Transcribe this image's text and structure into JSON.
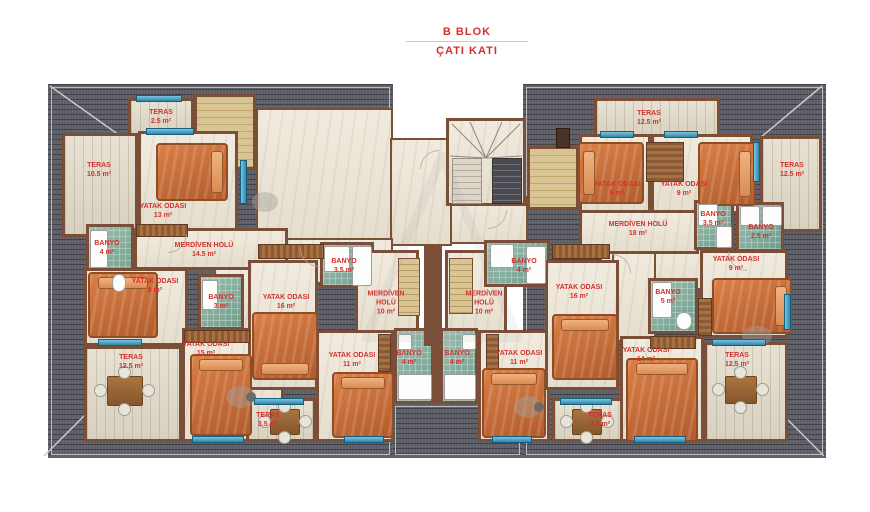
{
  "title": {
    "block": "B BLOK",
    "floor": "ÇATI KATI"
  },
  "colors": {
    "label": "#d4302e",
    "roof": "#5d5e66",
    "wall": "#7b4e38",
    "window": "#2e87ab",
    "bed": "#c96f3e",
    "tile": "#87afa0"
  },
  "rooms": [
    {
      "name": "TERAS",
      "area": "2.5 m²"
    },
    {
      "name": "TERAS",
      "area": "10.5 m²"
    },
    {
      "name": "YATAK ODASI",
      "area": "13 m²"
    },
    {
      "name": "BANYO",
      "area": "4 m²"
    },
    {
      "name": "MERDİVEN HOLÜ",
      "area": "14.5 m²"
    },
    {
      "name": "YATAK ODASI",
      "area": "9 m²"
    },
    {
      "name": "BANYO",
      "area": "3 m²"
    },
    {
      "name": "TERAS",
      "area": "12.5 m²"
    },
    {
      "name": "YATAK ODASI",
      "area": "15 m²"
    },
    {
      "name": "TERAS",
      "area": "3.5 m²"
    },
    {
      "name": "YATAK ODASI",
      "area": "16 m²"
    },
    {
      "name": "BANYO",
      "area": "3.5 m²"
    },
    {
      "name": "MERDİVEN HOLÜ",
      "area": "10 m²"
    },
    {
      "name": "YATAK ODASI",
      "area": "11 m²"
    },
    {
      "name": "BANYO",
      "area": "4 m²"
    },
    {
      "name": "BANYO",
      "area": "4 m²"
    },
    {
      "name": "YATAK ODASI",
      "area": "11 m²"
    },
    {
      "name": "TERAS",
      "area": "3.5 m²"
    },
    {
      "name": "BANYO",
      "area": "4 m²"
    },
    {
      "name": "MERDİVEN HOLÜ",
      "area": "10 m²"
    },
    {
      "name": "YATAK ODASI",
      "area": "16 m²"
    },
    {
      "name": "TERAS",
      "area": "12.5 m²"
    },
    {
      "name": "YATAK ODASI",
      "area": "9 m²"
    },
    {
      "name": "YATAK ODASI",
      "area": "9 m²"
    },
    {
      "name": "TERAS",
      "area": "12.5 m²"
    },
    {
      "name": "MERDİVEN HOLÜ",
      "area": "18 m²"
    },
    {
      "name": "BANYO",
      "area": "3.5 m²"
    },
    {
      "name": "BANYO",
      "area": "2.5 m²"
    },
    {
      "name": "YATAK ODASI",
      "area": "9 m²"
    },
    {
      "name": "BANYO",
      "area": "5 m²"
    },
    {
      "name": "YATAK ODASI",
      "area": "14 m²"
    },
    {
      "name": "TERAS",
      "area": "12.5 m²"
    }
  ]
}
